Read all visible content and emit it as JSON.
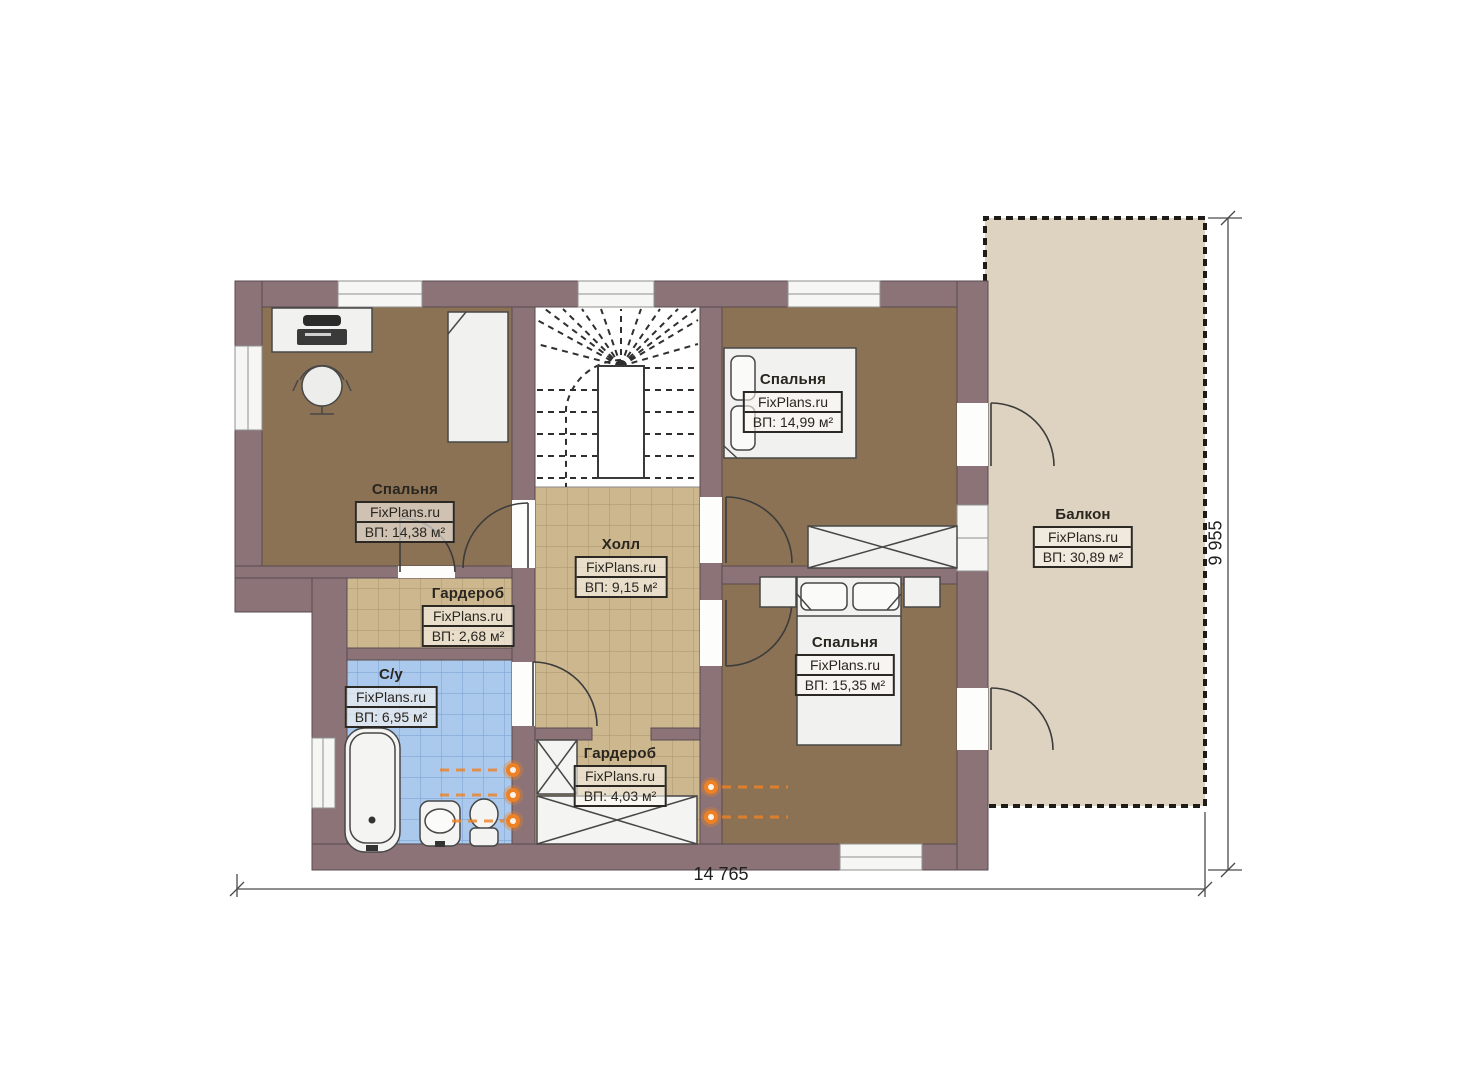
{
  "rooms": [
    {
      "id": "bedroom-top-left",
      "name": "Спальня",
      "brand": "FixPlans.ru",
      "area": "ВП: 14,38 м²"
    },
    {
      "id": "bedroom-top-right",
      "name": "Спальня",
      "brand": "FixPlans.ru",
      "area": "ВП: 14,99 м²"
    },
    {
      "id": "hall",
      "name": "Холл",
      "brand": "FixPlans.ru",
      "area": "ВП: 9,15 м²"
    },
    {
      "id": "wardrobe-small",
      "name": "Гардероб",
      "brand": "FixPlans.ru",
      "area": "ВП: 2,68 м²"
    },
    {
      "id": "bathroom",
      "name": "С/у",
      "brand": "FixPlans.ru",
      "area": "ВП: 6,95 м²"
    },
    {
      "id": "wardrobe-large",
      "name": "Гардероб",
      "brand": "FixPlans.ru",
      "area": "ВП: 4,03 м²"
    },
    {
      "id": "bedroom-bottom-right",
      "name": "Спальня",
      "brand": "FixPlans.ru",
      "area": "ВП: 15,35 м²"
    },
    {
      "id": "balcony",
      "name": "Балкон",
      "brand": "FixPlans.ru",
      "area": "ВП: 30,89 м²"
    }
  ],
  "dimensions": {
    "width_label": "14 765",
    "height_label": "9 955"
  },
  "palette": {
    "wall": "#8b7377",
    "wood_floor": "#8c7254",
    "tile_tan": "#cdb78f",
    "tile_blue": "#abc9ed",
    "balcony_floor": "#ded3c0",
    "outlet_orange": "#ef8125",
    "label_ink": "#2c2824"
  }
}
